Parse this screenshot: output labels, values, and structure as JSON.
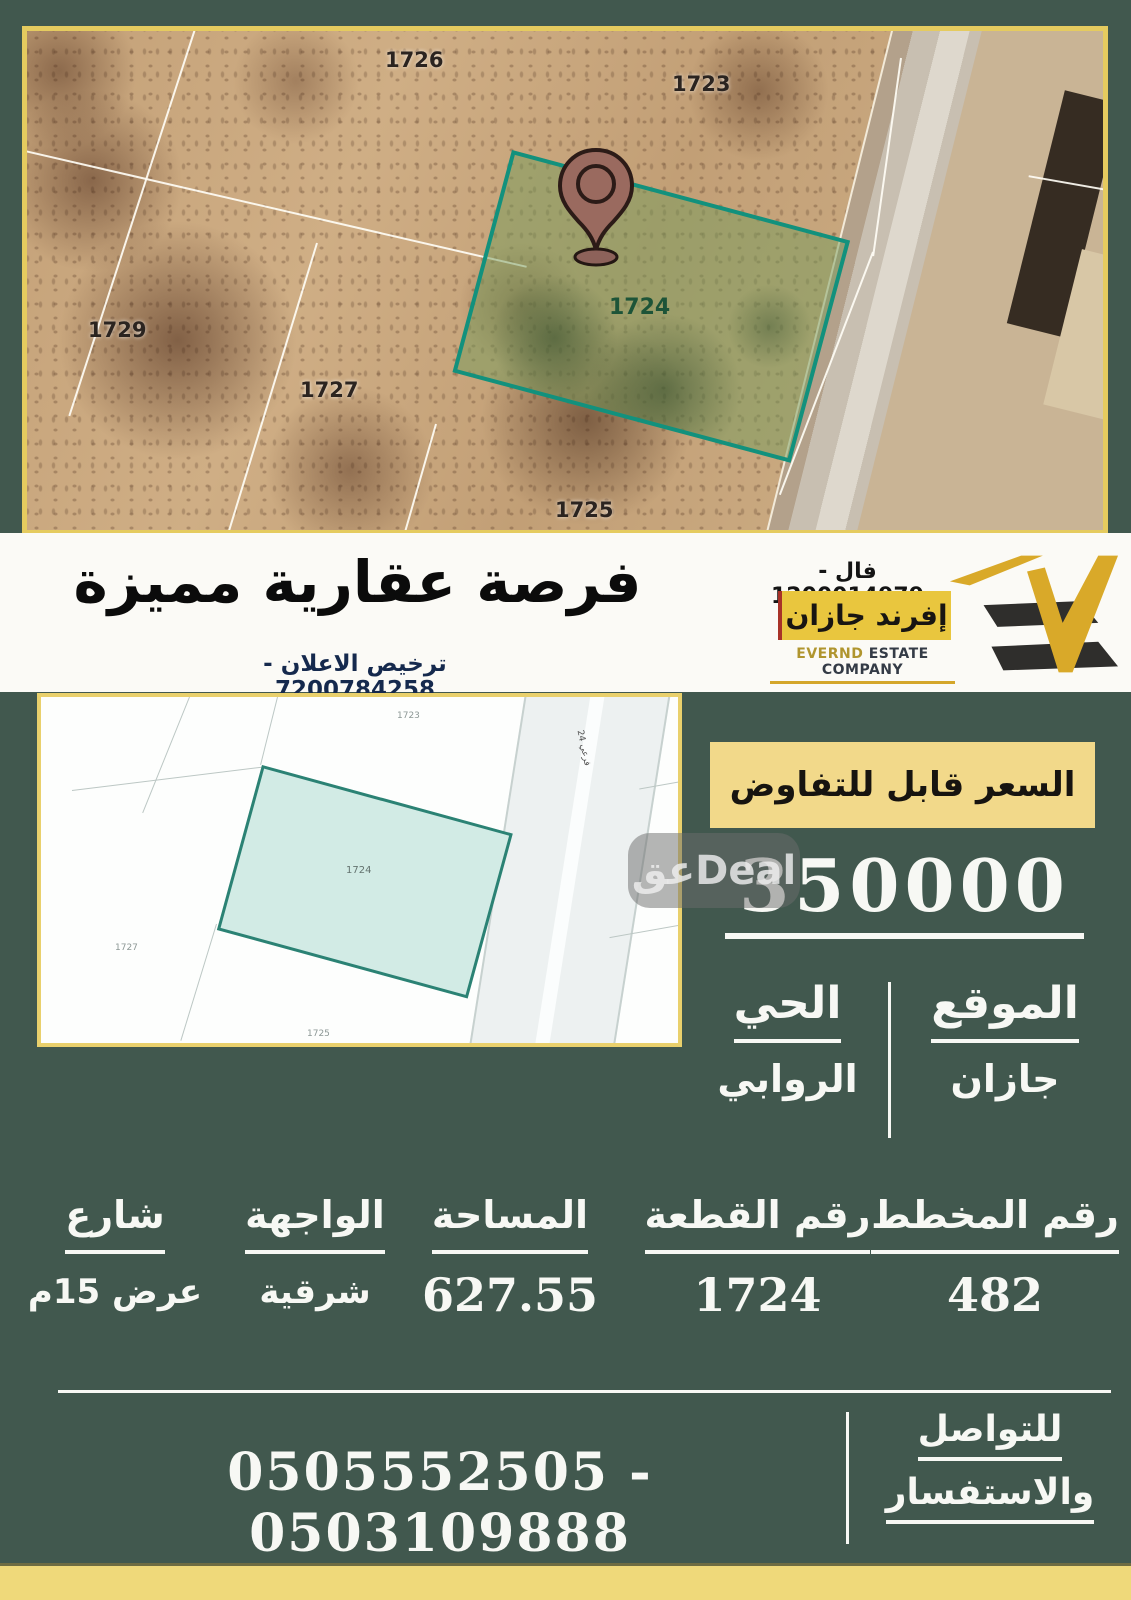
{
  "poster": {
    "satellite_map": {
      "plots": [
        "1726",
        "1723",
        "1729",
        "1727",
        "1725"
      ],
      "highlight_plot": "1724"
    },
    "banner": {
      "title": "فرصة عقارية مميزة",
      "license": "ترخيص الاعلان - 7200784258",
      "agent_phone": "فال - 1200014979",
      "brand_ar": "إفرند جازان",
      "brand_en_name": "EVERND",
      "brand_en_rest": " ESTATE COMPANY"
    },
    "cadastral_map": {
      "labels": [
        "1723",
        "1727",
        "1725"
      ],
      "highlight_plot": "1724",
      "road_label": "فرعي 24"
    },
    "watermark": "عقDeal",
    "pricing": {
      "negotiable": "السعر قابل للتفاوض",
      "price": "350000"
    },
    "location": {
      "label": "الموقع",
      "value": "جازان",
      "district_label": "الحي",
      "district_value": "الروابي"
    },
    "details": {
      "columns": [
        {
          "label": "رقم المخطط",
          "value": "482"
        },
        {
          "label": "رقم القطعة",
          "value": "1724"
        },
        {
          "label": "المساحة",
          "value": "627.55"
        },
        {
          "label": "الواجهة",
          "value": "شرقية"
        },
        {
          "label": "شارع",
          "value": "عرض 15م"
        }
      ]
    },
    "contact": {
      "label_line1": "للتواصل",
      "label_line2": "والاستفسار",
      "numbers": "0505552505 - 0503109888"
    },
    "colors": {
      "background": "#41584e",
      "accent_yellow": "#eed97a",
      "frame_yellow": "#e5cb5f",
      "brand_yellow": "#e9c63e",
      "teal_highlight": "#2b8274",
      "pin_maroon": "#9a6a5f"
    }
  }
}
